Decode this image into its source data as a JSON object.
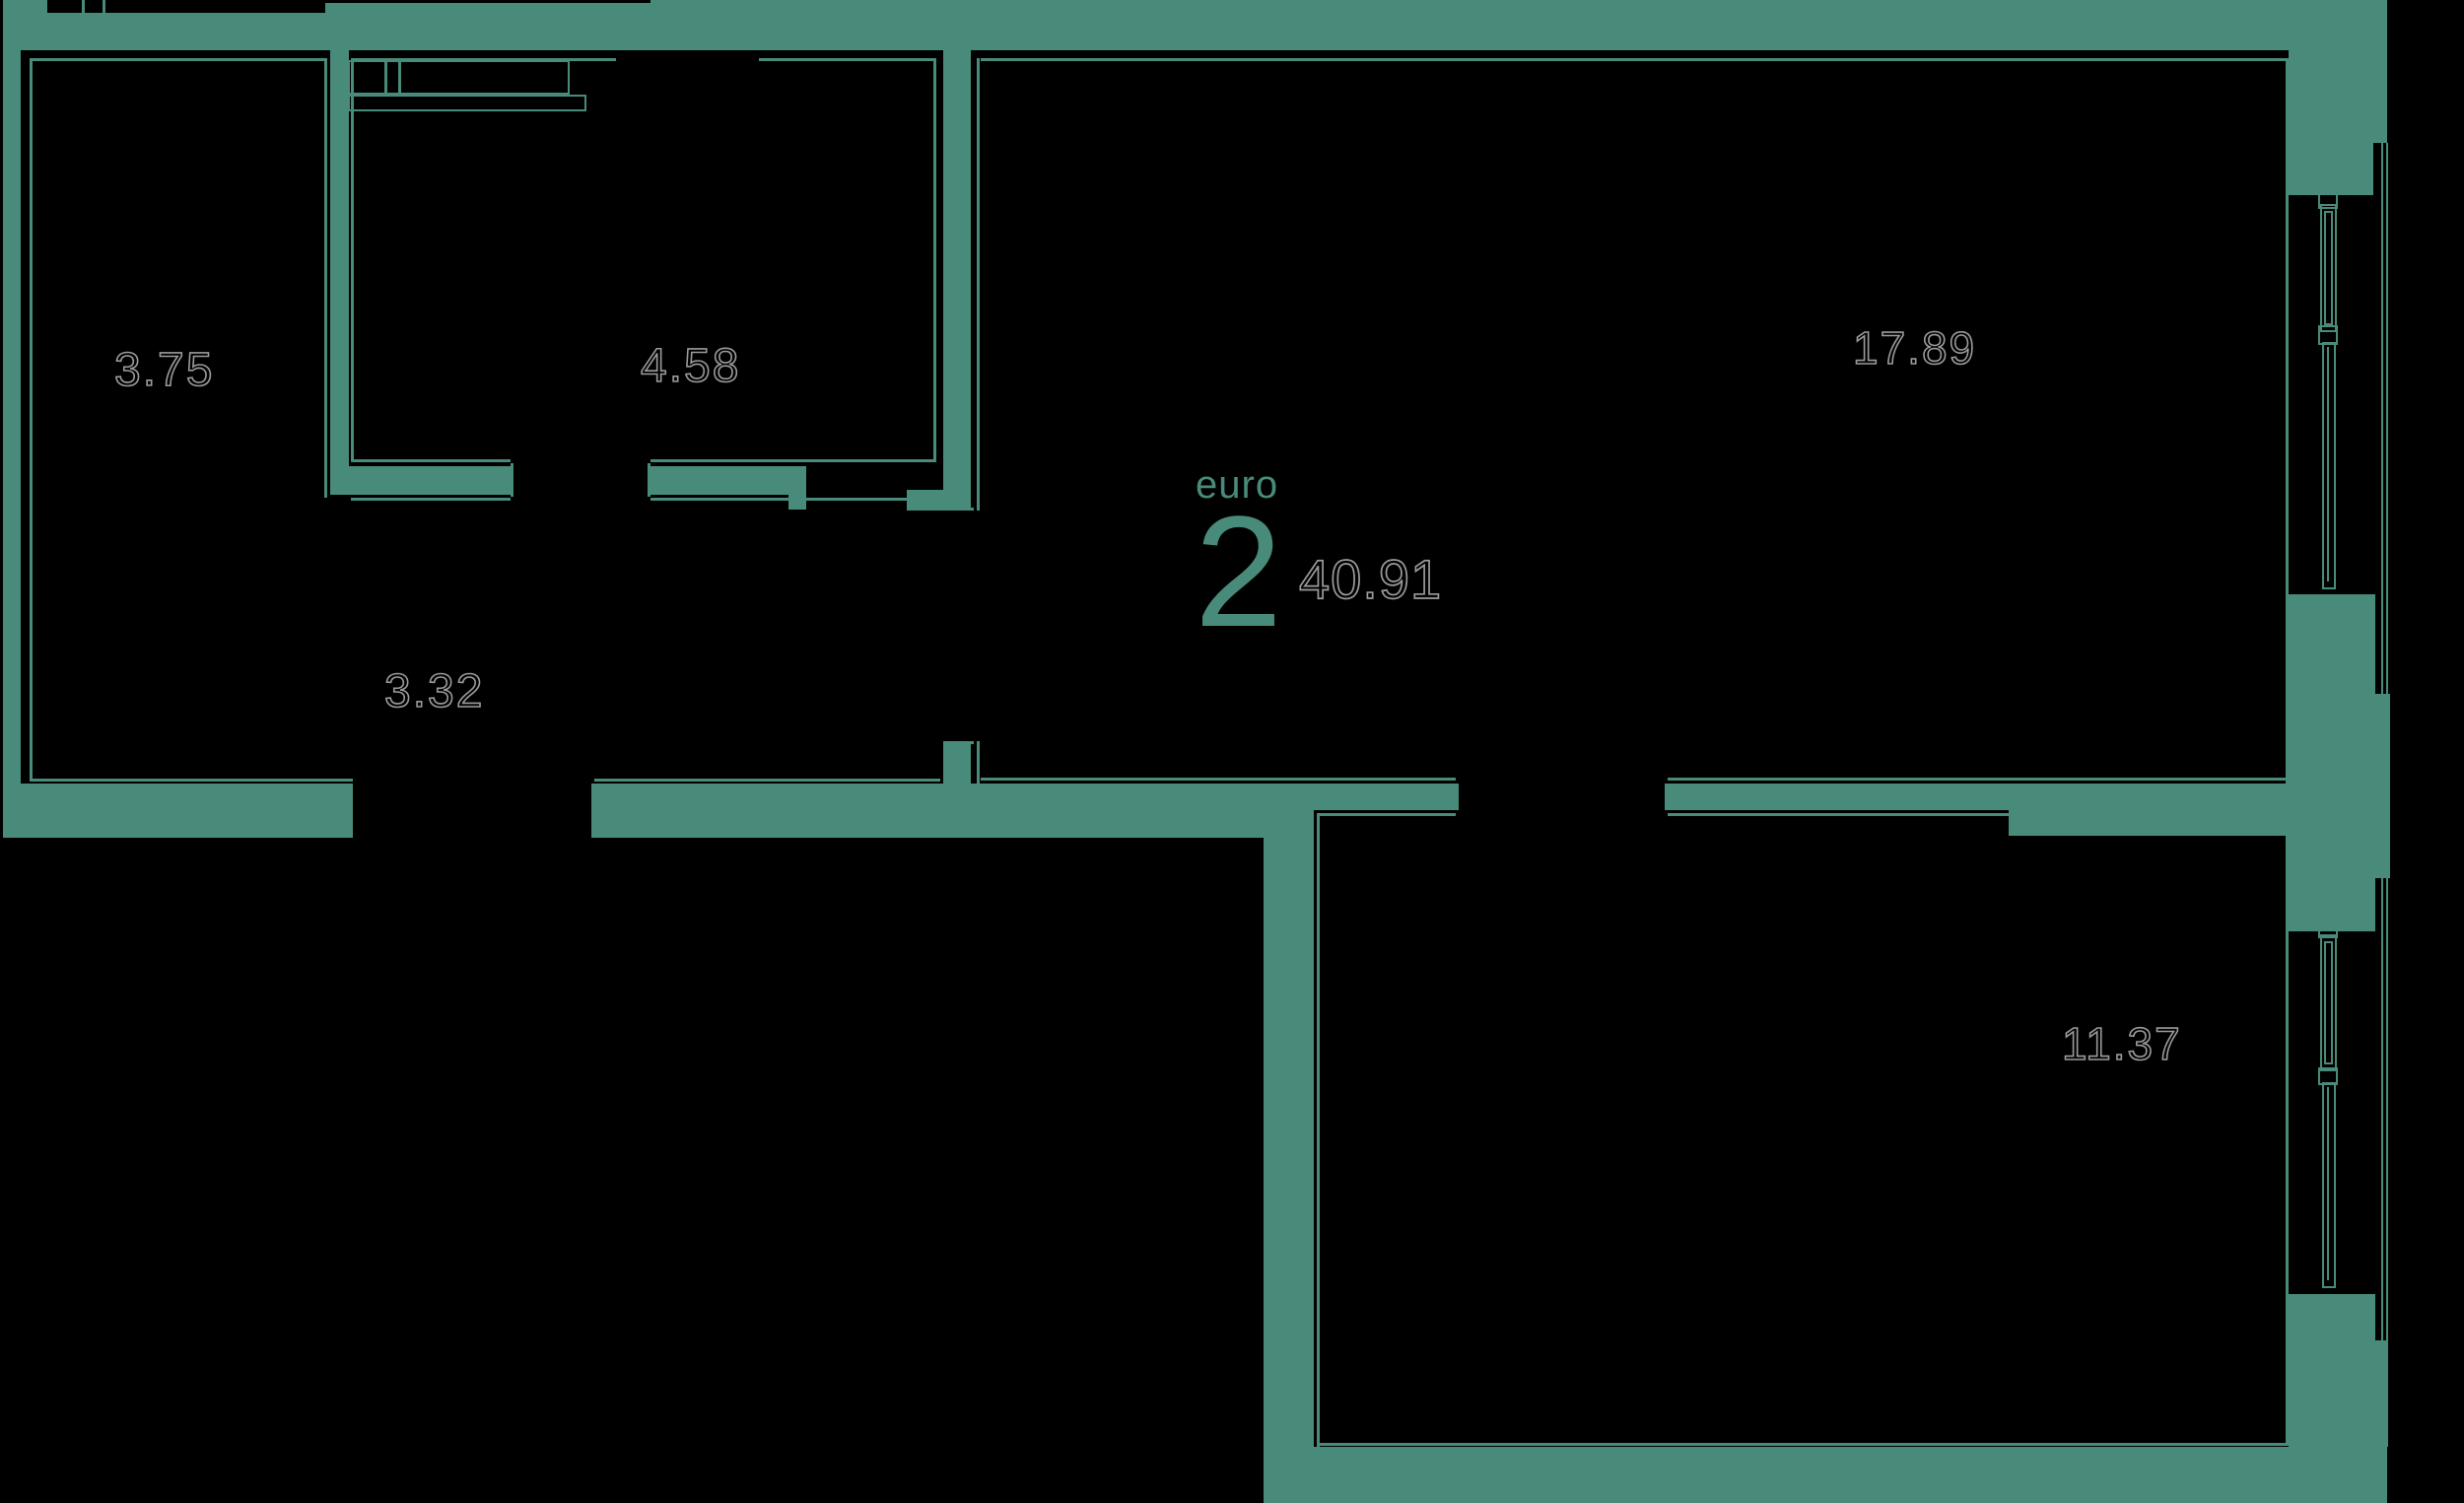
{
  "plan": {
    "unit": {
      "type_label": "euro",
      "rooms_count": "2",
      "total_area": "40.91"
    },
    "rooms": [
      {
        "id": "hall",
        "area": "3.75"
      },
      {
        "id": "bathroom",
        "area": "4.58"
      },
      {
        "id": "corridor",
        "area": "3.32"
      },
      {
        "id": "living-kitchen",
        "area": "17.89"
      },
      {
        "id": "bedroom",
        "area": "11.37"
      }
    ],
    "colors": {
      "wall": "#498b7a",
      "background": "#000000",
      "label_outline": "#9b9b9b"
    }
  }
}
